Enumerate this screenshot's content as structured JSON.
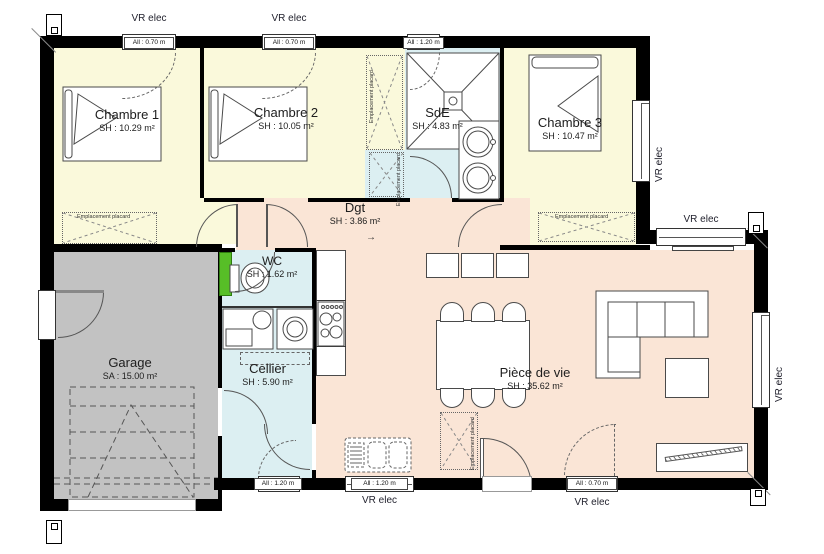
{
  "rooms": {
    "chambre1": {
      "name": "Chambre 1",
      "area": "SH : 10.29 m²"
    },
    "chambre2": {
      "name": "Chambre 2",
      "area": "SH : 10.05 m²"
    },
    "sde": {
      "name": "SdE",
      "area": "SH : 4.83 m²"
    },
    "chambre3": {
      "name": "Chambre 3",
      "area": "SH : 10.47 m²"
    },
    "dgt": {
      "name": "Dgt",
      "area": "SH : 3.86 m²"
    },
    "wc": {
      "name": "WC",
      "area": "SH : 1.62 m²"
    },
    "cellier": {
      "name": "Cellier",
      "area": "SH : 5.90 m²"
    },
    "garage": {
      "name": "Garage",
      "area": "SA : 15.00 m²"
    },
    "piece_de_vie": {
      "name": "Pièce de vie",
      "area": "SH : 35.62 m²"
    }
  },
  "labels": {
    "vr_elec": "VR elec",
    "placard": "Emplacement placard",
    "arrow": "→"
  },
  "windows": [
    {
      "id": "top-chambre1",
      "label": "All : 0.70 m",
      "vr": true
    },
    {
      "id": "top-chambre2",
      "label": "All : 0.70 m",
      "vr": true
    },
    {
      "id": "top-sde",
      "label": "All : 1.20 m",
      "vr": false
    },
    {
      "id": "right-chambre3",
      "vr": true
    },
    {
      "id": "top-piece-de-vie",
      "vr": true
    },
    {
      "id": "right-piece-de-vie",
      "vr": true
    },
    {
      "id": "bottom-cellier",
      "label": "All : 1.20 m",
      "vr": false
    },
    {
      "id": "bottom-kitchen",
      "label": "All : 1.20 m",
      "vr": true
    },
    {
      "id": "bottom-piece-de-vie",
      "label": "All : 0.70 m",
      "vr": true
    }
  ],
  "colors": {
    "wall": "#000000",
    "bedroom_fill": "#faf9db",
    "wet_room_fill": "#dceff2",
    "living_fill": "#fae5d6",
    "garage_fill": "#c2c2c2",
    "elec_panel_green": "#57be27"
  }
}
